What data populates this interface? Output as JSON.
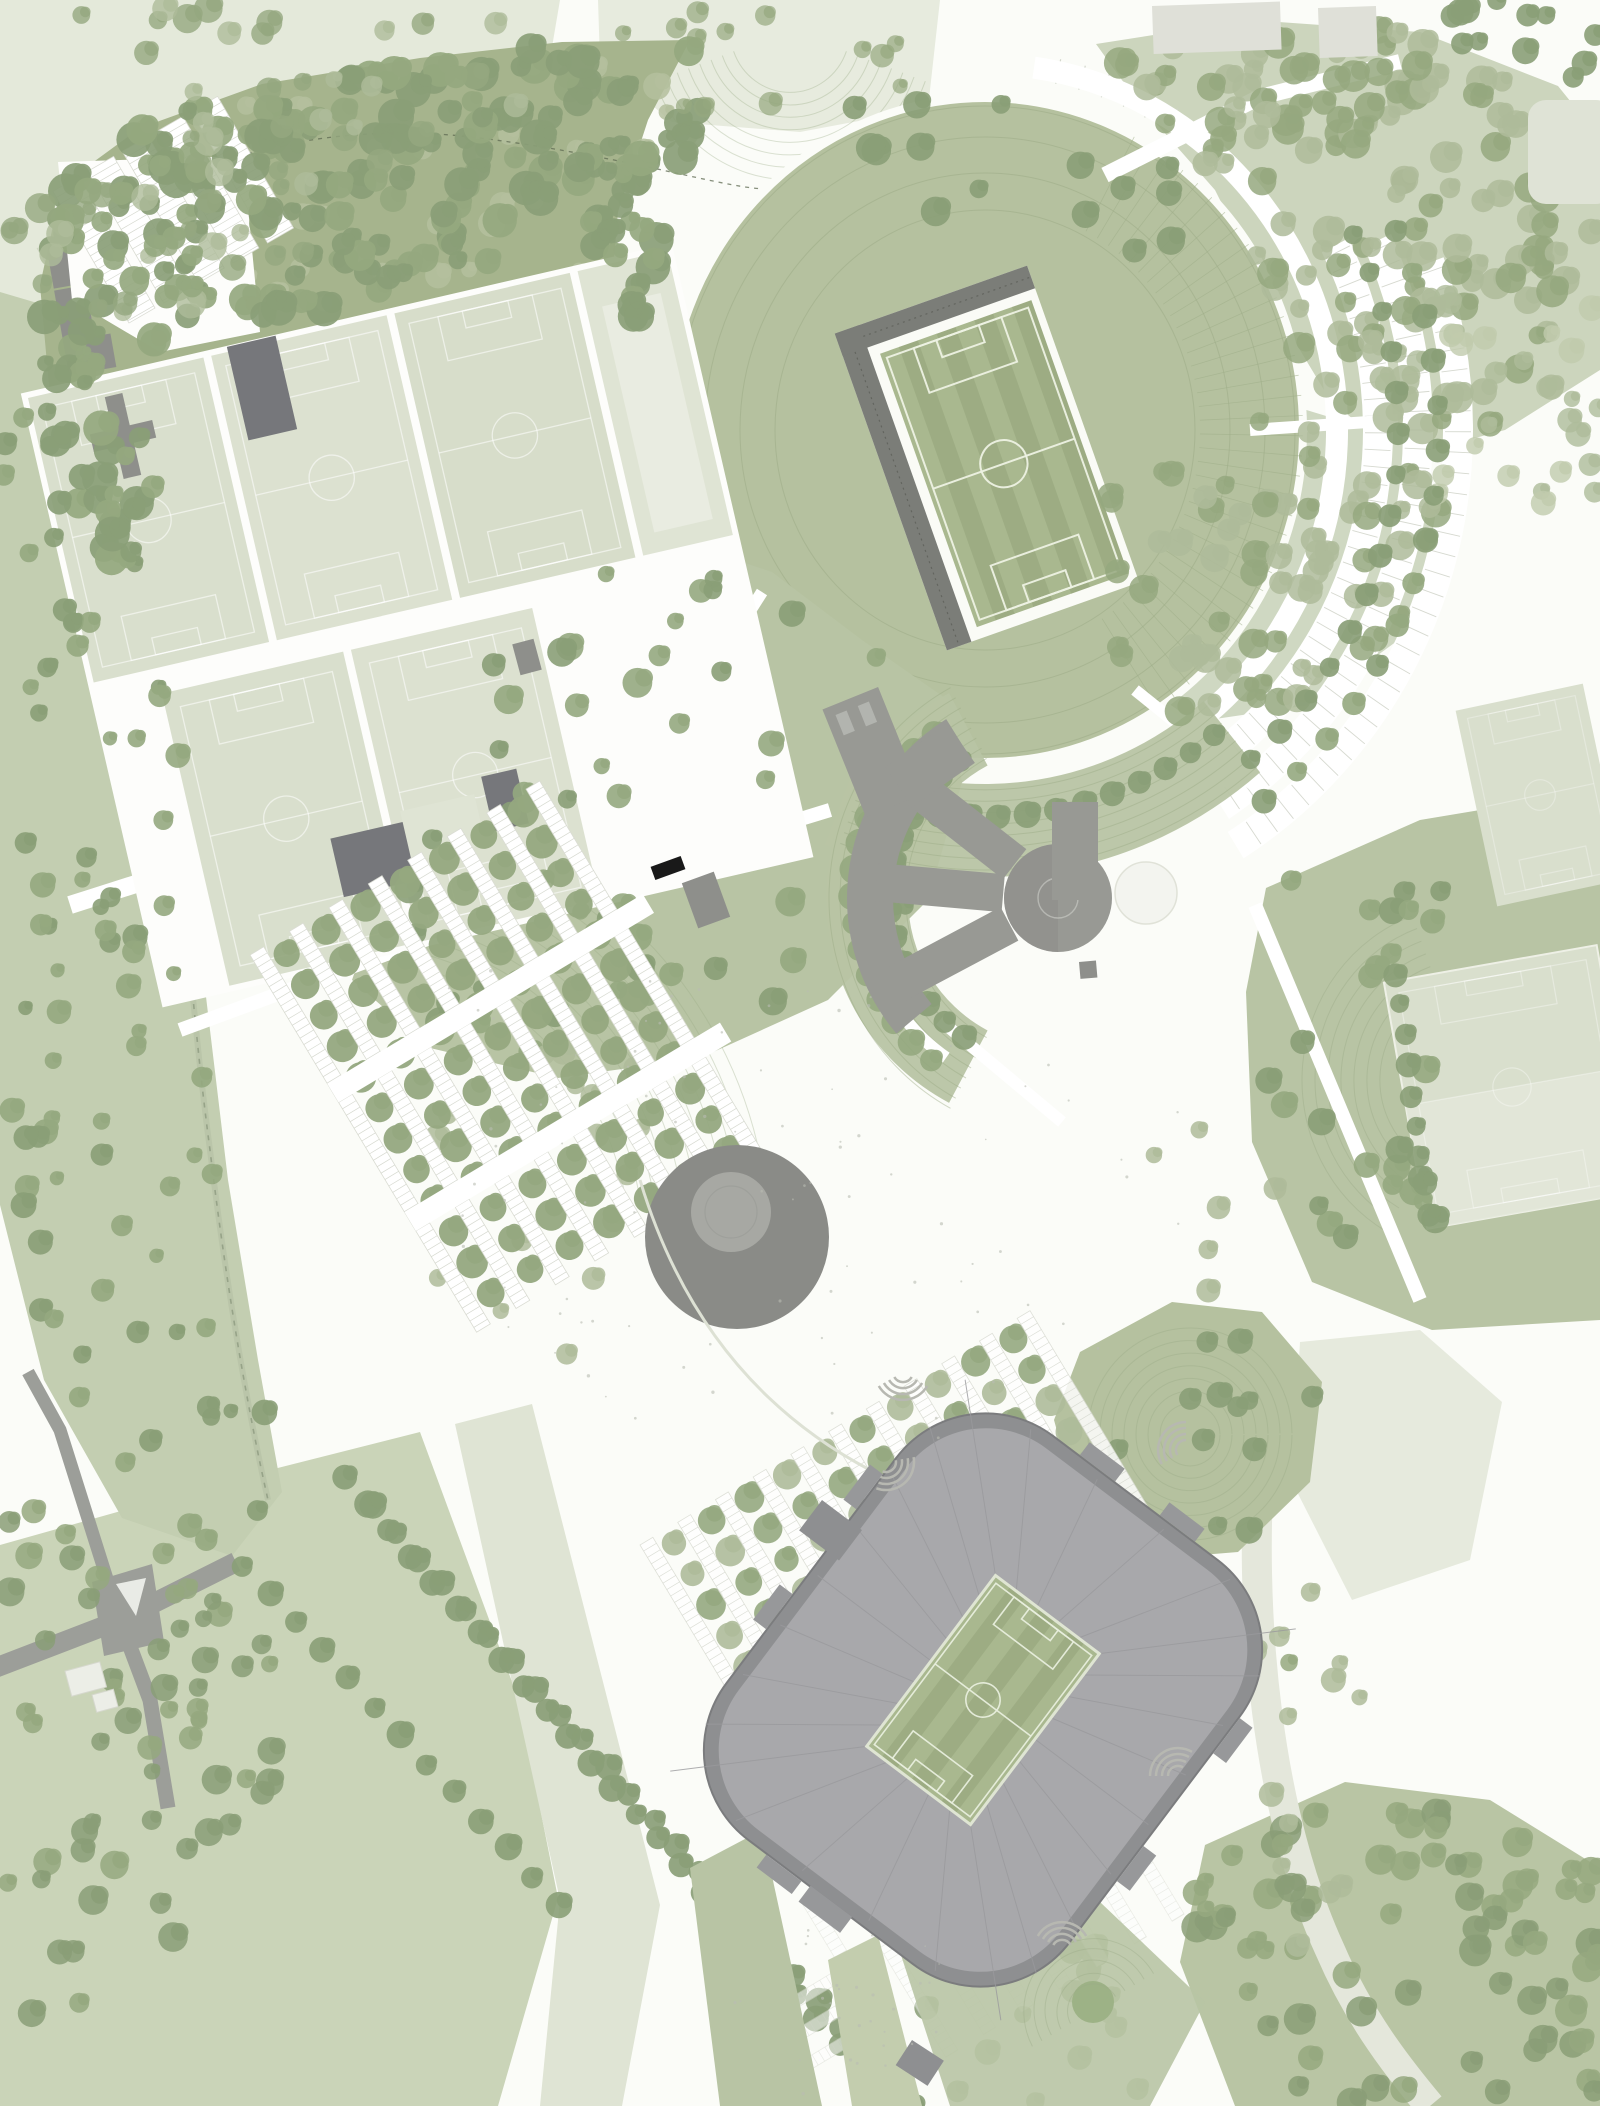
{
  "canvas": {
    "width": 1600,
    "height": 2106
  },
  "palette": {
    "bg": "#fbfcf8",
    "open": "#e4e9da",
    "open2": "#e7ebde",
    "field_pale": "#d9dfcd",
    "field_pale2": "#dfe4d4",
    "field_inner": "#e9ece1",
    "bowl": "#b5c19f",
    "lawn": "#b8c4a4",
    "forest_ground": "#a6b48d",
    "forest_ground_b": "#ccd5bd",
    "forest_ground_c": "#cfd8c2",
    "forest_ground_e": "#b9c5a4",
    "corridor_ground": "#c3ceb1",
    "bottom_field": "#cad4b8",
    "tree_dark": "#8a9e77",
    "tree_mid": "#95a87f",
    "tree_light": "#aebb9a",
    "tree_pale": "#c0cbad",
    "patch_light": "#b4c09d",
    "pitch_a": "#a9b88f",
    "pitch_b": "#9dac83",
    "pitch_line": "#edf1e3",
    "stand": "#7b7d78",
    "slab": "#76777b",
    "bldg": "#989994",
    "bldg_dark": "#8e8f8b",
    "roof": "#a8a8ab",
    "roof_edge": "#8e8f91",
    "roof_line": "#9a9a9d",
    "circle_outer": "#8a8b87",
    "circle_inner": "#a7a8a3",
    "road": "#9c9e99",
    "path": "#ffffff",
    "stall": "#d2d5cb",
    "contour": "#9cab86",
    "pale_path": "#e4e7db",
    "knoll": "#9db286",
    "plaza_dot": "#b9bdb2"
  },
  "features": [
    "forest",
    "open-parkland",
    "training-pitches",
    "equipment-buildings",
    "top-left-parking",
    "training-stadium-bowl",
    "training-stadium-pitch",
    "grandstand",
    "curved-parking-rows",
    "ring-road",
    "headquarters-building",
    "circular-hub",
    "circular-pavilion",
    "event-plaza",
    "orchard-parking",
    "tree-avenue",
    "access-roads",
    "road-junction",
    "main-stadium-roof",
    "main-stadium-pitch",
    "stair-arcs",
    "landscaped-mounds",
    "practice-pitch-east",
    "park-paths",
    "bottom-field"
  ]
}
